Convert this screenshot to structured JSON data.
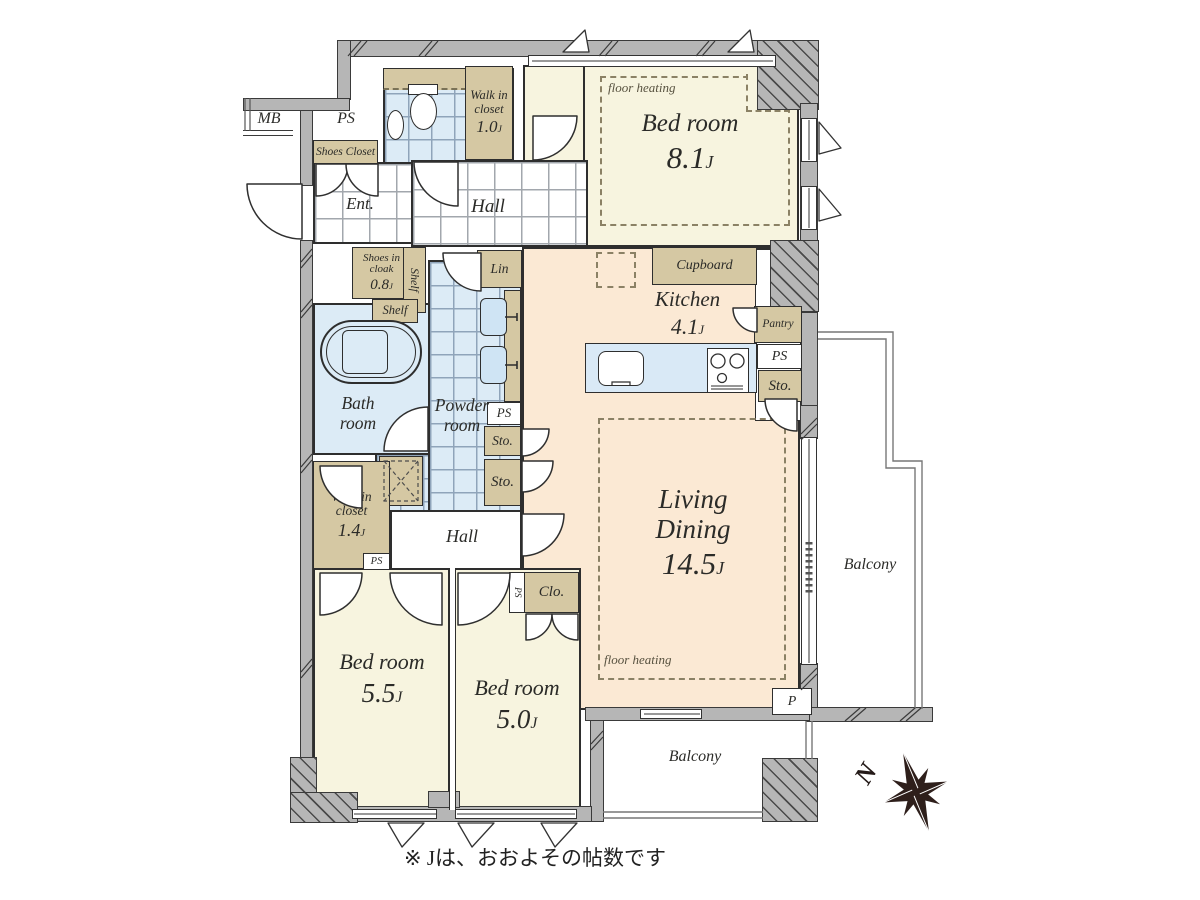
{
  "note": "※ Jは、おおよその帖数です",
  "compass": {
    "north": "N"
  },
  "colors": {
    "wall": "#b6b6b6",
    "bedroom_floor": "#f7f4df",
    "ldk_floor": "#fbe9d4",
    "wet_floor": "#dcebf6",
    "cabinet": "#d5c8a3",
    "outline": "#2e2e2e"
  },
  "rooms": {
    "bedroom_main": {
      "name": "Bed room",
      "size_num": "8.1",
      "size_unit": "J",
      "floor_heating": "floor heating"
    },
    "living_dining": {
      "name": "Living Dining",
      "size_num": "14.5",
      "size_unit": "J",
      "floor_heating": "floor heating"
    },
    "kitchen": {
      "name": "Kitchen",
      "size_num": "4.1",
      "size_unit": "J"
    },
    "bedroom_55": {
      "name": "Bed room",
      "size_num": "5.5",
      "size_unit": "J"
    },
    "bedroom_50": {
      "name": "Bed room",
      "size_num": "5.0",
      "size_unit": "J"
    },
    "bath": {
      "name": "Bath room"
    },
    "powder": {
      "name": "Powder room"
    },
    "entrance": {
      "name": "Ent."
    },
    "hall_upper": {
      "name": "Hall"
    },
    "hall_lower": {
      "name": "Hall"
    },
    "wic_upper": {
      "name": "Walk in closet",
      "size_num": "1.0",
      "size_unit": "J"
    },
    "wic_lower": {
      "name": "Walk in closet",
      "size_num": "1.4",
      "size_unit": "J"
    },
    "shoes_cloak": {
      "name": "Shoes in cloak",
      "size_num": "0.8",
      "size_unit": "J"
    },
    "balcony_right": {
      "name": "Balcony"
    },
    "balcony_bottom": {
      "name": "Balcony"
    }
  },
  "storage": {
    "shoes_closet": "Shoes Closet",
    "shelf_vertical": "Shelf",
    "shelf_horizontal": "Shelf",
    "linen": "Lin",
    "cupboard": "Cupboard",
    "pantry": "Pantry",
    "sto_kitchen": "Sto.",
    "sto_mid_upper": "Sto.",
    "sto_mid_lower": "Sto.",
    "closet": "Clo."
  },
  "service": {
    "meter_box": "MB",
    "ps_entry": "PS",
    "ps_kitchen": "PS",
    "ps_powder": "PS",
    "ps_hall": "PS",
    "ps_bedroom": "PS",
    "pipe": "P"
  }
}
